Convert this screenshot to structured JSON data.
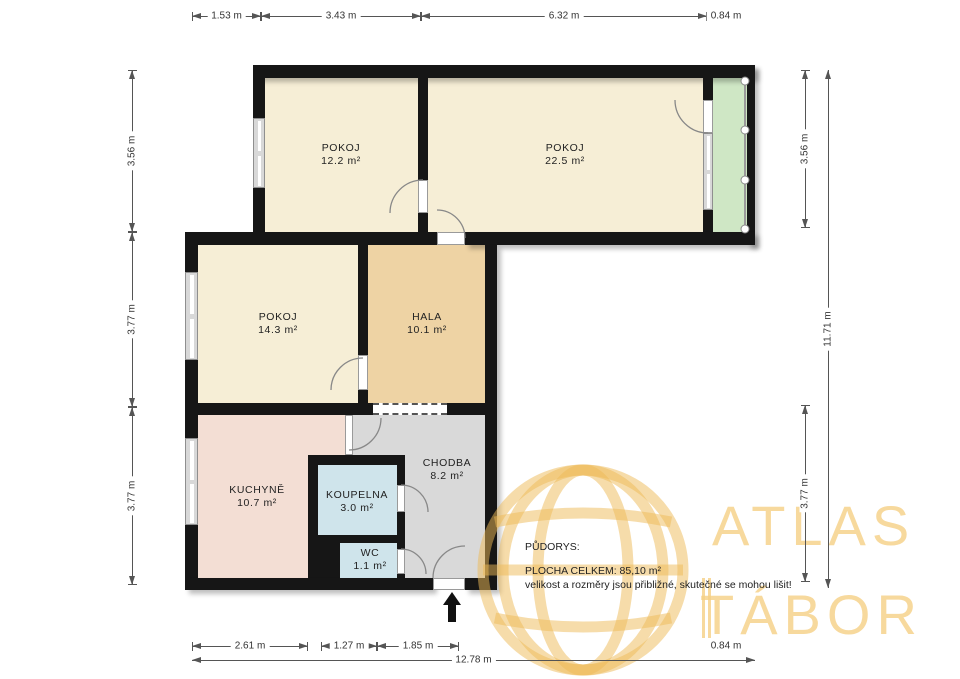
{
  "rooms": {
    "pokoj1": {
      "name": "POKOJ",
      "area": "12.2 m²"
    },
    "pokoj2": {
      "name": "POKOJ",
      "area": "22.5 m²"
    },
    "pokoj3": {
      "name": "POKOJ",
      "area": "14.3 m²"
    },
    "hala": {
      "name": "HALA",
      "area": "10.1 m²"
    },
    "kuchyne": {
      "name": "KUCHYNĚ",
      "area": "10.7 m²"
    },
    "koupelna": {
      "name": "KOUPELNA",
      "area": "3.0 m²"
    },
    "wc": {
      "name": "WC",
      "area": "1.1 m²"
    },
    "chodba": {
      "name": "CHODBA",
      "area": "8.2 m²"
    }
  },
  "dimensions": {
    "top": [
      "1.53 m",
      "3.43 m",
      "6.32 m",
      "0.84 m"
    ],
    "left": [
      "3.56 m",
      "3.77 m",
      "3.77 m"
    ],
    "right": [
      "3.56 m",
      "3.77 m",
      "11.71 m"
    ],
    "bottom": [
      "2.61 m",
      "1.27 m",
      "1.85 m",
      "0.84 m",
      "12.78 m"
    ]
  },
  "legend": {
    "title": "PŮDORYS:",
    "total": "PLOCHA CELKEM: 85,10  m²",
    "note": "velikost a rozměry jsou přibližné, skutečné se mohou lišit!"
  },
  "watermark": {
    "line1": "ATLAS",
    "line2": "TÁBOR"
  },
  "colors": {
    "wall": "#161616",
    "room_cream": "#f6eed6",
    "hala_tan": "#eed3a4",
    "kitchen_pink": "#f3ded4",
    "bath_blue": "#cfe4eb",
    "corridor_gray": "#d9d9d9",
    "balcony_green": "#cfe7c5",
    "watermark_gold": "#edb956",
    "dimension_text": "#333333"
  }
}
